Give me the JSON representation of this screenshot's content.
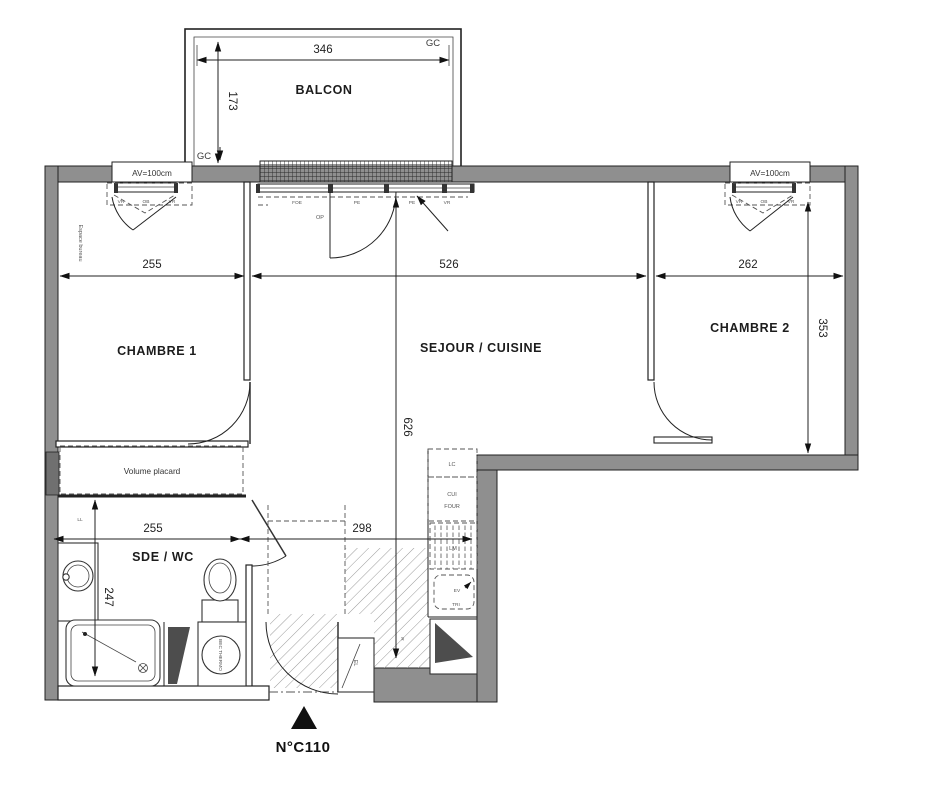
{
  "drawing": {
    "unit": "N°C110",
    "colors": {
      "wall": "#8f8f8f",
      "line": "#222222",
      "muted": "#555555",
      "accent": "#4d4d4d"
    },
    "rooms": {
      "balcon": "BALCON",
      "chambre1": "CHAMBRE 1",
      "sejour": "SEJOUR / CUISINE",
      "chambre2": "CHAMBRE 2",
      "sde": "SDE / WC"
    },
    "dimensions": {
      "balcon_width": "346",
      "balcon_depth": "173",
      "chambre1_width": "255",
      "sejour_width": "526",
      "chambre2_width": "262",
      "chambre2_depth": "353",
      "sejour_depth": "626",
      "sde_width": "255",
      "entry_width": "298",
      "sde_depth": "247"
    },
    "annotations": {
      "gc_top": "GC",
      "gc_bottom": "GC",
      "av_left": "AV=100cm",
      "av_right": "AV=100cm",
      "espace_bureau": "Espace bureau",
      "volume_placard": "Volume placard",
      "ll": "LL",
      "op": "OP",
      "lc": "LC",
      "cui": "CUI",
      "four": "FOUR",
      "lm": "LM",
      "ev": "EV",
      "tri": "TRI",
      "el": "EL",
      "r": "R",
      "bec_thermo": "BEC THERMO",
      "bay_tags": {
        "foe": "FOE",
        "pe1": "PE",
        "pe2": "PE",
        "vr": "VR"
      },
      "window_left_tags": {
        "vr1": "VR",
        "ob": "OB",
        "vr2": "VR"
      },
      "window_right_tags": {
        "vr1": "VR",
        "ob": "OB",
        "vr2": "VR"
      }
    }
  }
}
